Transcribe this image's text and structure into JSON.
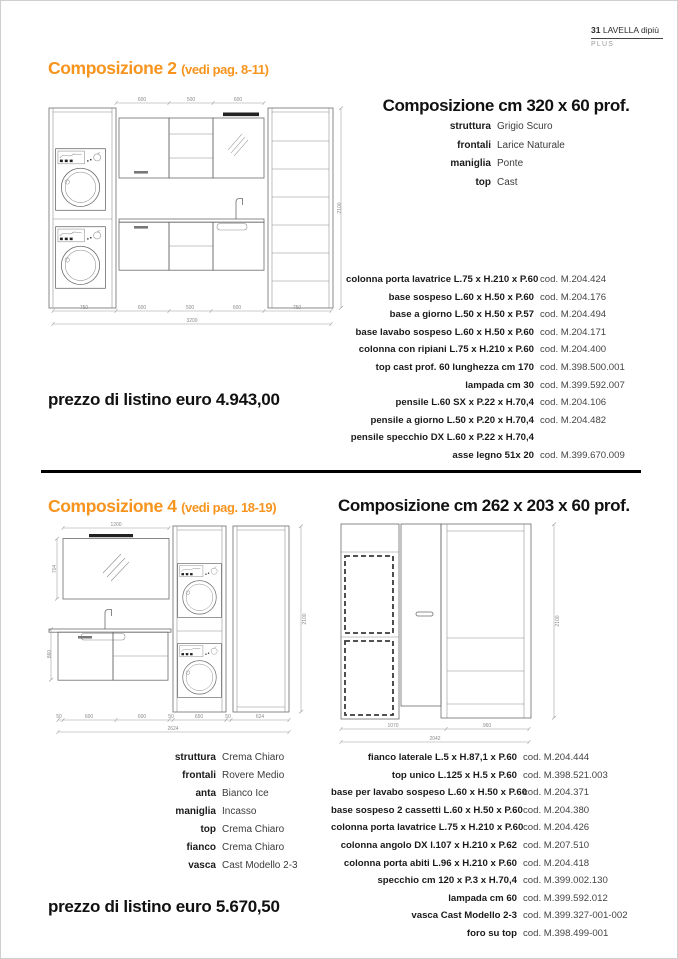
{
  "header": {
    "page_number": "31",
    "brand": "LAVELLA dipiù",
    "series": "PLUS"
  },
  "comp2": {
    "title": "Composizione 2",
    "subtitle": "(vedi pag. 8-11)",
    "size_title": "Composizione cm 320 x 60 prof.",
    "specs": [
      {
        "label": "struttura",
        "value": "Grigio Scuro"
      },
      {
        "label": "frontali",
        "value": "Larice Naturale"
      },
      {
        "label": "maniglia",
        "value": "Ponte"
      },
      {
        "label": "top",
        "value": "Cast"
      }
    ],
    "items": [
      {
        "name": "colonna porta lavatrice L.75 x H.210 x P.60",
        "code": "cod. M.204.424"
      },
      {
        "name": "base sospeso L.60 x H.50 x P.60",
        "code": "cod. M.204.176"
      },
      {
        "name": "base a giorno L.50 x H.50 x P.57",
        "code": "cod. M.204.494"
      },
      {
        "name": "base lavabo sospeso L.60 x H.50 x P.60",
        "code": "cod. M.204.171"
      },
      {
        "name": "colonna con ripiani L.75 x H.210 x P.60",
        "code": "cod. M.204.400"
      },
      {
        "name": "top cast prof. 60 lunghezza cm 170",
        "code": "cod. M.398.500.001"
      },
      {
        "name": "lampada cm 30",
        "code": "cod. M.399.592.007"
      },
      {
        "name": "pensile L.60 SX x P.22 x H.70,4",
        "code": "cod. M.204.106"
      },
      {
        "name": "pensile a giorno L.50 x P.20 x H.70,4",
        "code": "cod. M.204.482"
      },
      {
        "name": "pensile specchio DX L.60 x P.22 x H.70,4",
        "code": "cod. M.204.115"
      },
      {
        "name": "asse legno 51x 20",
        "code": "cod. M.399.670.009"
      }
    ],
    "price": "prezzo di listino euro 4.943,00",
    "drawing": {
      "dims_top": [
        "600",
        "500",
        "600"
      ],
      "dims_bottom": [
        "750",
        "600",
        "500",
        "600",
        "750"
      ],
      "dim_total": "3200",
      "dim_height": "2100"
    }
  },
  "comp4": {
    "title": "Composizione 4",
    "subtitle": "(vedi pag. 18-19)",
    "size_title": "Composizione cm 262 x 203 x 60 prof.",
    "specs": [
      {
        "label": "struttura",
        "value": "Crema Chiaro"
      },
      {
        "label": "frontali",
        "value": "Rovere Medio"
      },
      {
        "label": "anta",
        "value": "Bianco Ice"
      },
      {
        "label": "maniglia",
        "value": "Incasso"
      },
      {
        "label": "top",
        "value": "Crema Chiaro"
      },
      {
        "label": "fianco",
        "value": "Crema Chiaro"
      },
      {
        "label": "vasca",
        "value": "Cast Modello 2-3"
      }
    ],
    "items": [
      {
        "name": "fianco laterale L.5 x H.87,1 x P.60",
        "code": "cod. M.204.444"
      },
      {
        "name": "top unico L.125 x H.5 x P.60",
        "code": "cod. M.398.521.003"
      },
      {
        "name": "base per lavabo sospeso L.60 x H.50 x P.60",
        "code": "cod. M.204.371"
      },
      {
        "name": "base sospeso 2 cassetti L.60 x H.50 x P.60",
        "code": "cod. M.204.380"
      },
      {
        "name": "colonna porta lavatrice L.75 x H.210 x P.60",
        "code": "cod. M.204.426"
      },
      {
        "name": "colonna angolo DX l.107 x H.210 x P.62",
        "code": "cod. M.207.510"
      },
      {
        "name": "colonna porta abiti L.96 x H.210 x P.60",
        "code": "cod. M.204.418"
      },
      {
        "name": "specchio cm 120 x P.3 x H.70,4",
        "code": "cod. M.399.002.130"
      },
      {
        "name": "lampada cm 60",
        "code": "cod. M.399.592.012"
      },
      {
        "name": "vasca Cast Modello 2-3",
        "code": "cod. M.399.327-001-002"
      },
      {
        "name": "foro su top",
        "code": "cod. M.398.499-001"
      }
    ],
    "price": "prezzo di listino euro 5.670,50",
    "drawing_front": {
      "dim_top": "1200",
      "dim_mirror_height": "704",
      "dim_base_height": "860",
      "dim_height": "2100",
      "dims_bottom": [
        "50",
        "600",
        "600",
        "50",
        "650",
        "50",
        "624"
      ],
      "dim_total": "2624"
    },
    "drawing_side": {
      "dims_bottom": [
        "1070",
        "960"
      ],
      "dim_total": "2042",
      "dim_height": "2100"
    }
  }
}
